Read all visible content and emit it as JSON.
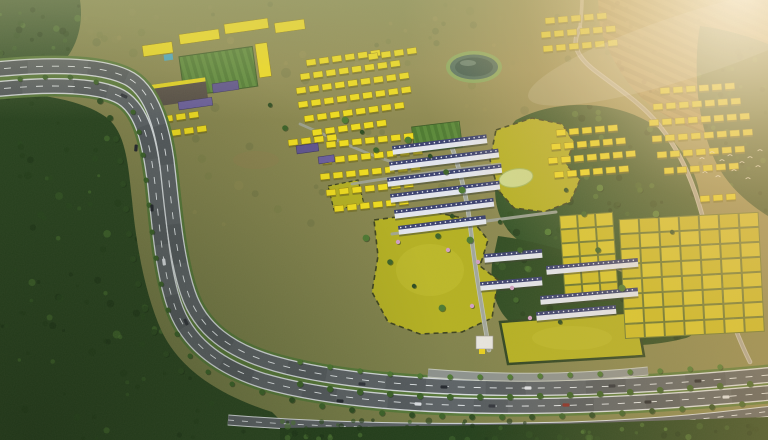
{
  "scene": {
    "type": "aerial-architectural-rendering",
    "description": "Aerial golden-hour 3D rendering of a master-planned township: yellow-roofed villa clusters, white townhouse rows with navy roof bands, chartreuse vacant plots with dashed boundaries, a small lake, gridded land parcels, all surrounded by dense dark-green forest, with a curved multi-lane highway sweeping from the top-left around to the bottom edge, cars on the road, tree-lined medians, a flock of white birds over the right-hand forest and warm sun flare over terraced hills in the top-right corner.",
    "aria_label": "Aerial rendering of a township development beside a curved highway at golden hour",
    "time_of_day": "golden hour"
  },
  "features": {
    "forest_regions": [
      "left-forest",
      "bottom-left-forest",
      "center-right-upper-forest",
      "center-right-lower-forest",
      "right-edge-forest"
    ],
    "highway_carriageways": 3,
    "villa_cluster_count": 8,
    "townhouse_cluster_count": 2,
    "parcel_grid_count": 2,
    "lake_count": 1,
    "pond_count": 1,
    "bird_count": 12,
    "car_count": 19
  },
  "palette": {
    "terrain_low": "#6f7a44",
    "terrain_mid": "#85854e",
    "terrain_high": "#9a925a",
    "forest_left": "#2b4721",
    "forest_dark": "#24401c",
    "forest_upper": "#315227",
    "forest_lower": "#2d4b22",
    "canopy_specks": [
      "#1d3517",
      "#2c4d20",
      "#3c6329",
      "#4e7a33",
      "#243f1b"
    ],
    "scrub_specks": [
      "#6e7a42",
      "#8a8a52",
      "#9f9458",
      "#55663a"
    ],
    "roof_yellow": "#f0dd1e",
    "roof_shadow": "#6e6a22",
    "villa_stroke": "#8a7a10",
    "town_body": "#e4e7ef",
    "town_navy": "#3a4170",
    "town_shadow": "#3a4030",
    "parcel_fill": "#d9c82b",
    "parcel_alt": "#cdbd24",
    "parcel_stroke": "#6d7a30",
    "olive_plot": "#b5b122",
    "plot_dash": "#3e4420",
    "hedge_dark": "#2f4522",
    "asphalt": "#5d6367",
    "asphalt_wet": "#4e5458",
    "road_white": "#d8dde0",
    "lane_dash": "#e8edf0",
    "verge_green": "#587a3a",
    "inner_road": "#a2a79c",
    "winding_road": "#c9c4b4",
    "tree_dark": "#2e4d22",
    "tree_mid": "#3c6329",
    "tree_light": "#4e7a33",
    "tree_shadow": "#1c2f15",
    "pink_tree": "#d2a0c4",
    "lake_rim": "#86a85c",
    "lake_mid": "#47685c",
    "lake_deep": "#33524a",
    "pond": "#cfdb8d",
    "purple_building": "#5f5490",
    "campus_gray": "#564e46",
    "lawn_a": "#4d7a31",
    "lawn_b": "#5b8a3a",
    "pool_blue": "#49a8c6",
    "gate_white": "#e8e6e0",
    "car_colors": [
      "#23272e",
      "#dfe3e8",
      "#30343c",
      "#8a2f28"
    ],
    "bird_white": "#f5f3ea",
    "flare_warm": "#fff0d0",
    "dirt_tan": "#9a8a55"
  }
}
